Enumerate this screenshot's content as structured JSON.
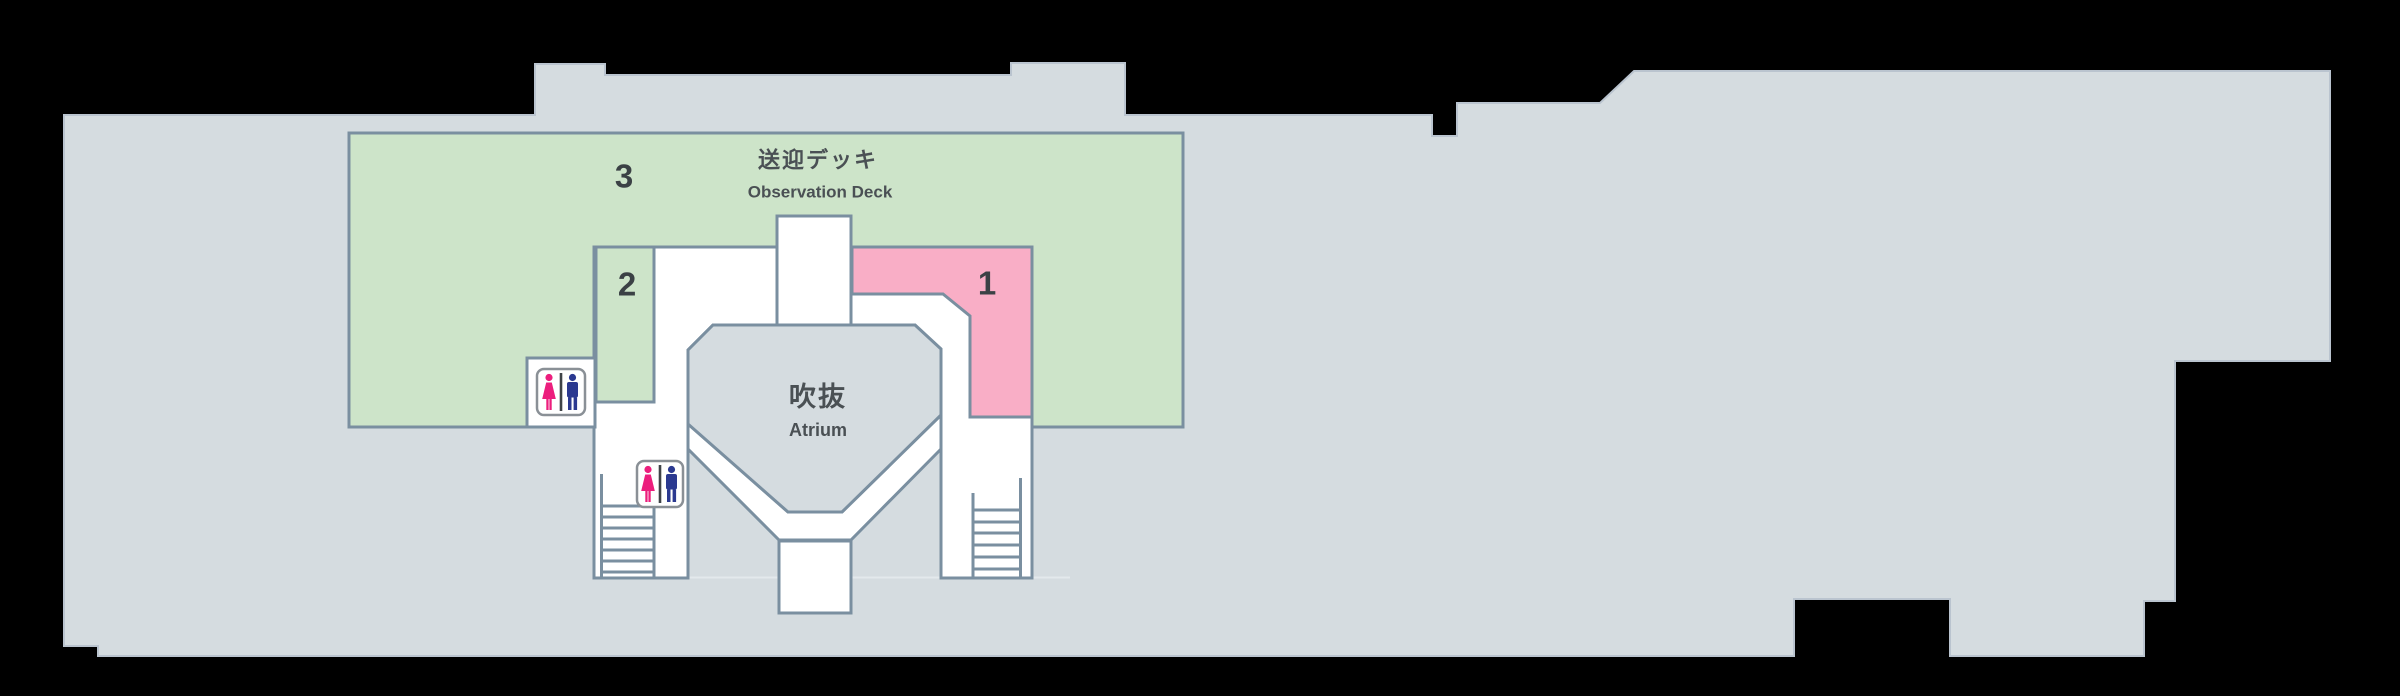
{
  "title": "Terminal floor map - 3F Observation Deck level",
  "building": {
    "background": "#000000",
    "fill": "#d5dce0",
    "edge": "#bac4cf",
    "wall": "#7a8fa0",
    "floor_line": "#e3e9ec"
  },
  "deck": {
    "number": "3",
    "name_jp": "送迎デッキ",
    "name_en": "Observation Deck",
    "fill": "#cde4c9"
  },
  "room2": {
    "number": "2",
    "fill": "#cde4c9"
  },
  "room1": {
    "number": "1",
    "fill": "#f9aec6"
  },
  "atrium": {
    "name_jp": "吹抜",
    "name_en": "Atrium",
    "fill": "#d5dce0"
  },
  "restroom": {
    "female_color": "#ec1e7d",
    "male_color": "#2b3990",
    "frame_color": "#8a9096",
    "divider_color": "#3f4347",
    "sign_fill": "#ffffff"
  }
}
